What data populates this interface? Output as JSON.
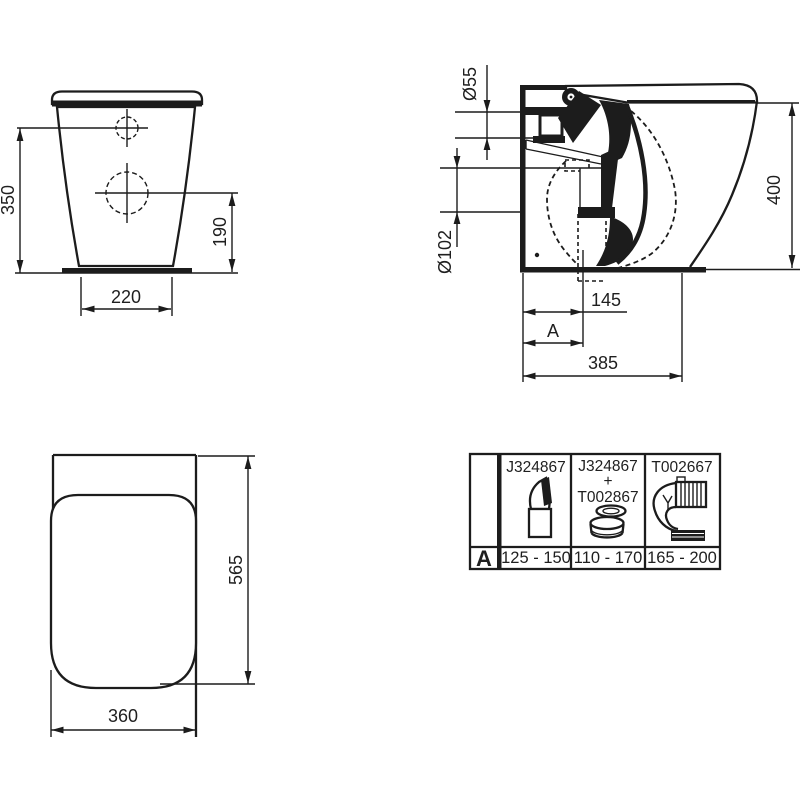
{
  "drawing": {
    "front_view": {
      "dim_height": "350",
      "dim_hole_height": "190",
      "dim_base_width": "220"
    },
    "side_view": {
      "dim_inlet_diameter": "Ø55",
      "dim_outlet_diameter": "Ø102",
      "dim_height": "400",
      "dim_outlet_setout": "145",
      "dim_outlet_setout_variable": "A",
      "dim_depth": "385"
    },
    "plan_view": {
      "dim_depth": "565",
      "dim_width": "360"
    }
  },
  "adapter_table": {
    "row_label": "A",
    "columns": [
      {
        "part": "J324867",
        "range": "125 - 150",
        "icon": "angled-outlet-connector-icon"
      },
      {
        "part_top": "J324867",
        "part_plus": "+",
        "part_bottom": "T002867",
        "range": "110 - 170",
        "icon": "offset-seal-connector-icon"
      },
      {
        "part": "T002667",
        "range": "165 - 200",
        "icon": "flexible-elbow-connector-icon"
      }
    ]
  },
  "colors": {
    "ink": "#1c1c1c",
    "paper": "#ffffff"
  }
}
